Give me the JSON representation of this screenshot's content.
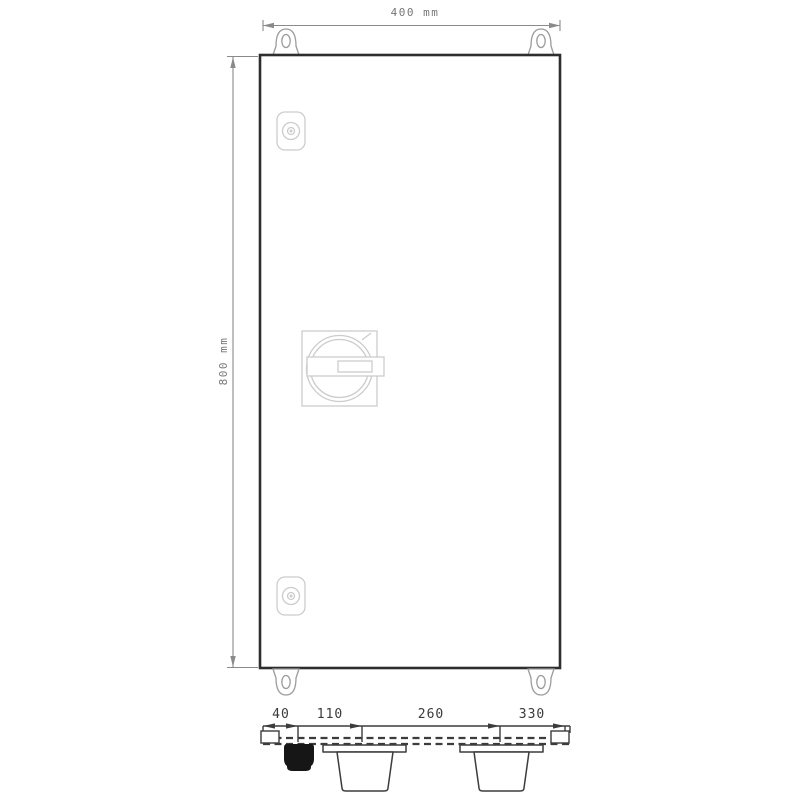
{
  "drawing": {
    "title": "enclosure-dimension-drawing",
    "front_view": {
      "width_dim_label": "400 mm",
      "height_dim_label": "800 mm"
    },
    "bottom_view": {
      "dim_labels": [
        "40",
        "110",
        "260",
        "330"
      ]
    },
    "colors": {
      "background": "#ffffff",
      "enclosure_outline": "#2e2e2e",
      "mounting_lug_line": "#9b9b9b",
      "door_hardware_line": "#cccccc",
      "front_dimension_line": "#8a8a8a",
      "bottom_view_line": "#3c3c3c",
      "cable_gland_fill": "#161616"
    }
  }
}
